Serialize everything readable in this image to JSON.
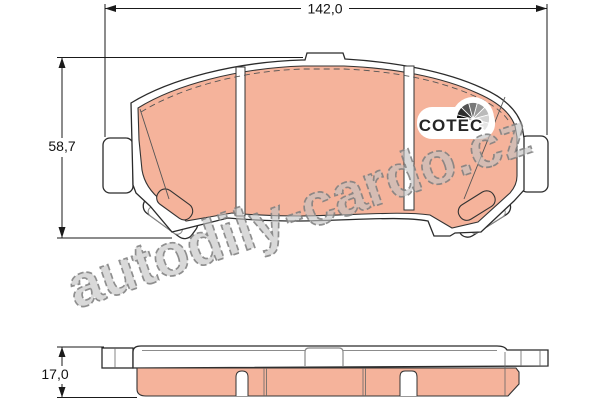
{
  "dimensions": {
    "width": "142,0",
    "height": "58,7",
    "thickness": "17,0"
  },
  "logo": {
    "text": "COTEC"
  },
  "watermark": {
    "text": "autodily-cardo.cz"
  },
  "colors": {
    "friction": "#f5b39b",
    "backplate": "#ffffff",
    "outline": "#2b2b2b",
    "watermark_fill": "#c2c2c2",
    "watermark_stroke": "#7e7e7e"
  }
}
